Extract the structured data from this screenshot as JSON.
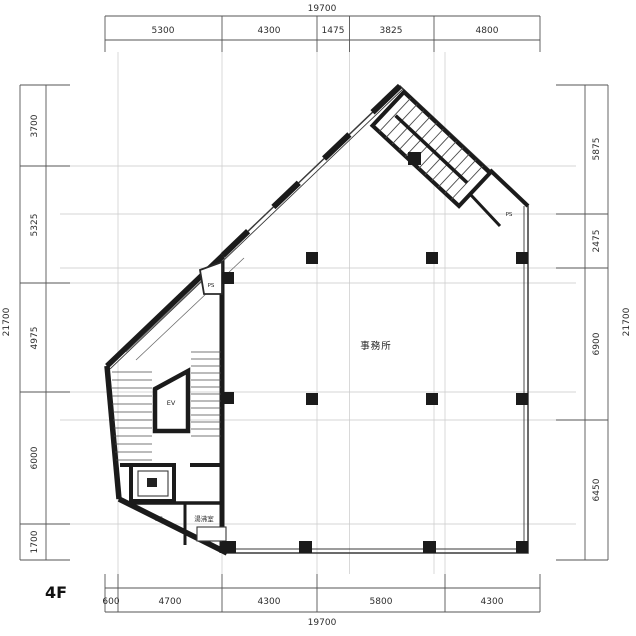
{
  "floor_label": "4F",
  "dims": {
    "top": {
      "total": "19700",
      "segments": [
        "5300",
        "4300",
        "1475",
        "3825",
        "4800"
      ]
    },
    "bottom": {
      "total": "19700",
      "segments": [
        "600",
        "4700",
        "4300",
        "5800",
        "4300"
      ]
    },
    "left": {
      "total": "21700",
      "segments": [
        "3700",
        "5325",
        "4975",
        "6000",
        "1700"
      ]
    },
    "right": {
      "total": "21700",
      "segments": [
        "5875",
        "2475",
        "6900",
        "6450"
      ]
    }
  },
  "labels": {
    "office": "事務所",
    "elevator": "EV",
    "ps_upper": "PS",
    "ps_lower": "PS",
    "ps_corner": "PS",
    "kitchenette": "湯沸室"
  },
  "colors": {
    "wall": "#1b1b1b",
    "thin_line": "#3a3a3a",
    "grid": "#c9c9c9",
    "dim_text": "#2d2d2d"
  }
}
